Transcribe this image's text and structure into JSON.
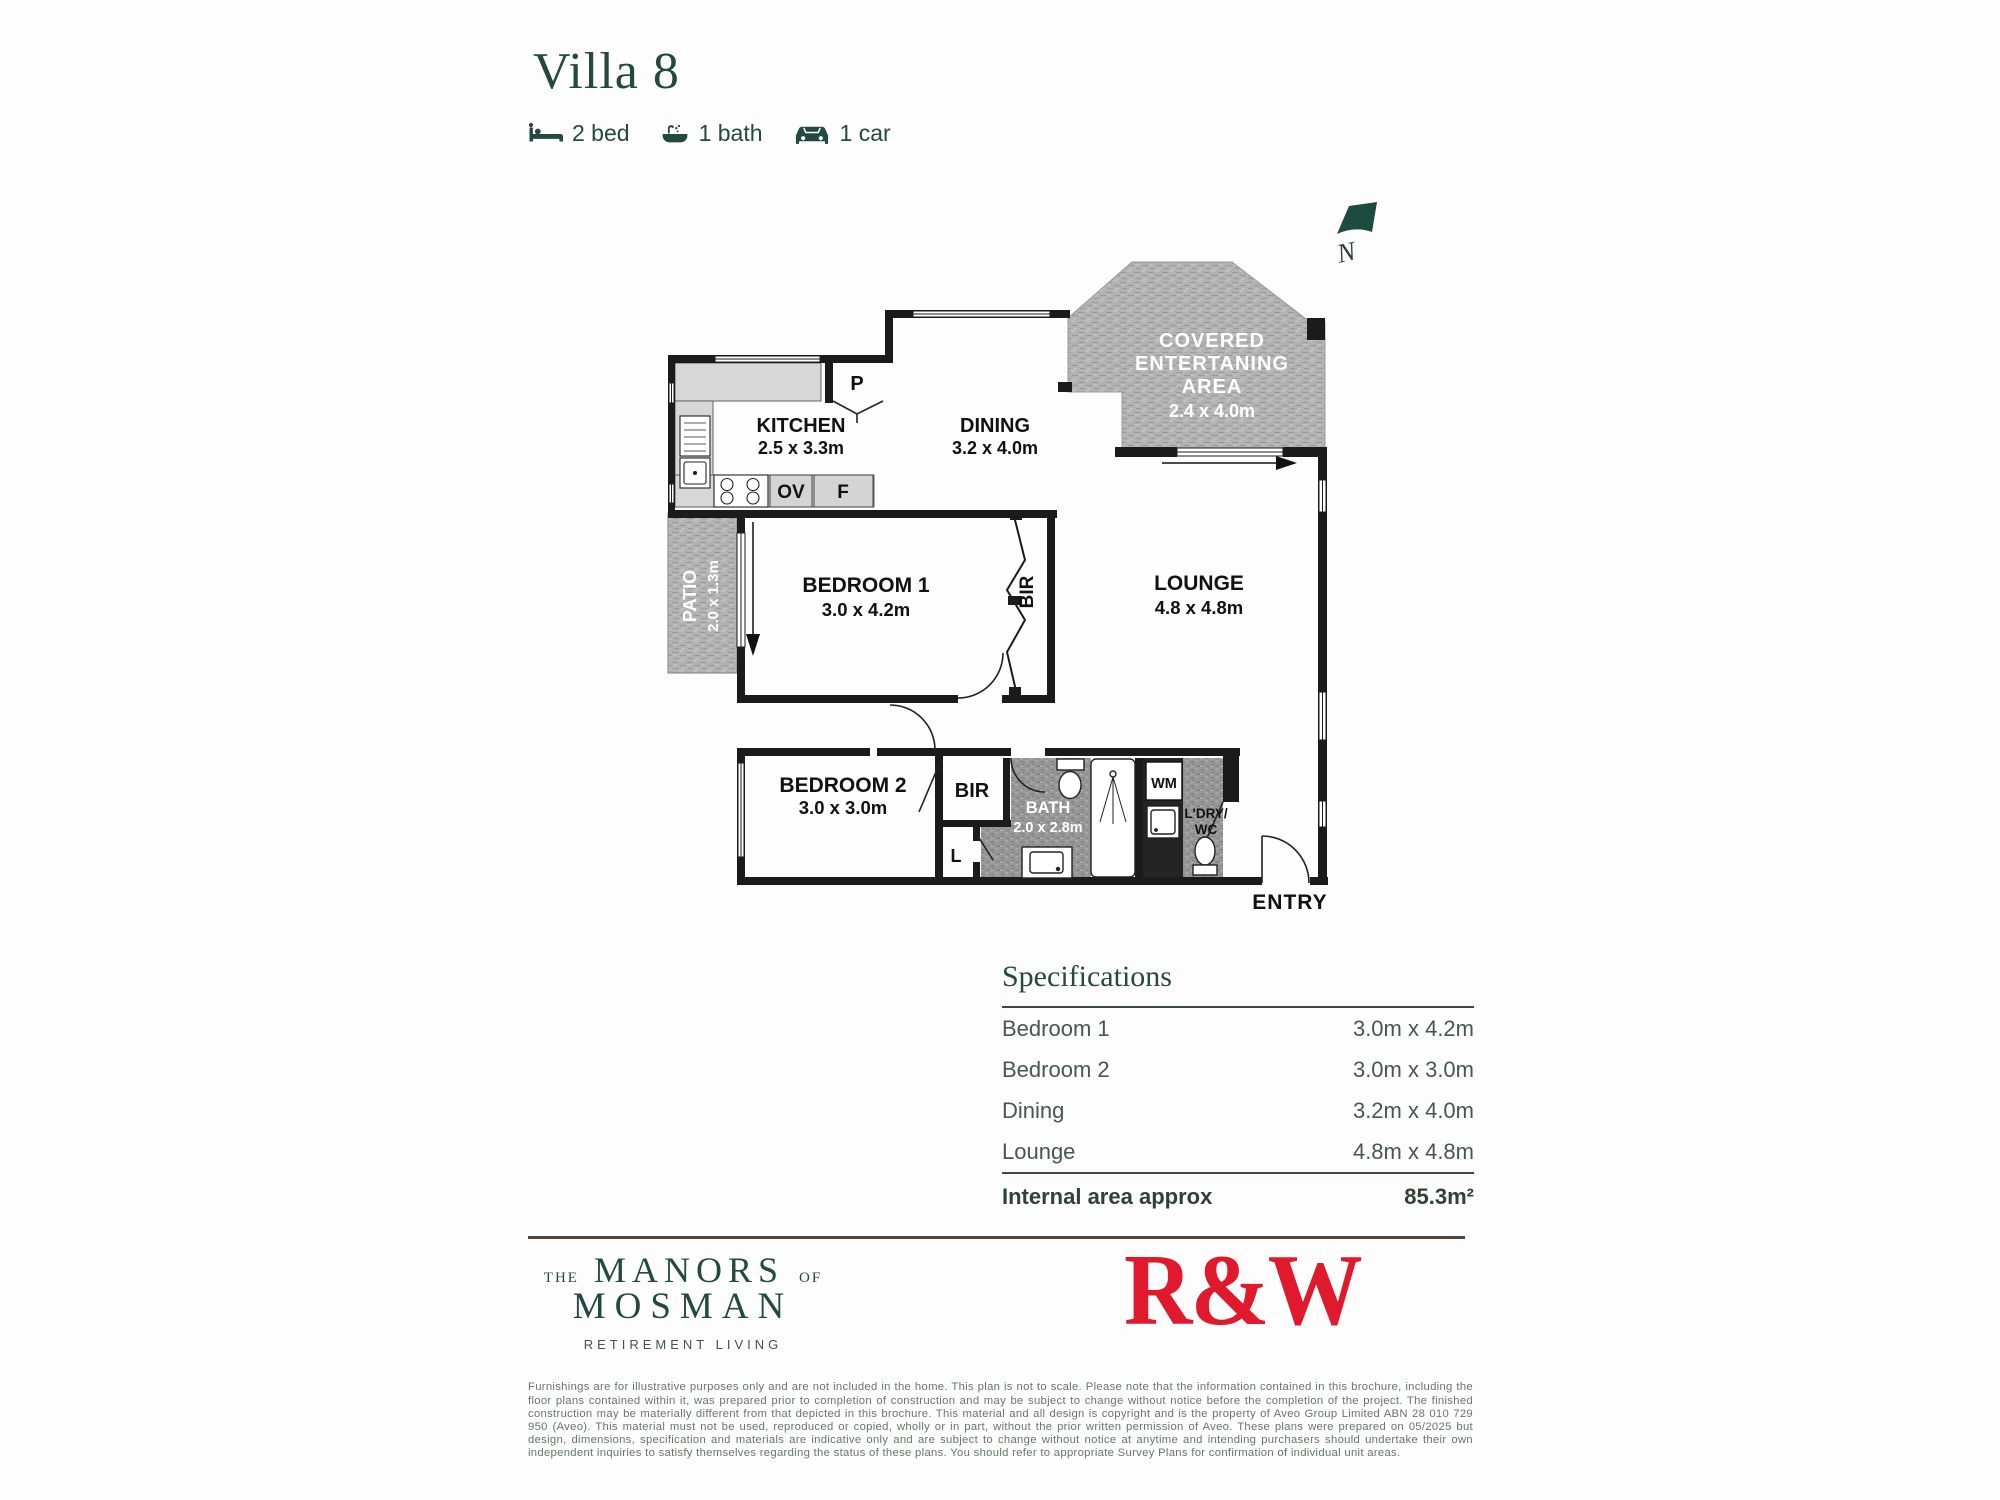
{
  "header": {
    "title": "Villa 8",
    "features": [
      {
        "icon": "bed-icon",
        "label": "2 bed"
      },
      {
        "icon": "bath-icon",
        "label": "1 bath"
      },
      {
        "icon": "car-icon",
        "label": "1 car"
      }
    ]
  },
  "floorplan": {
    "north": "N",
    "rooms": {
      "kitchen": {
        "name": "KITCHEN",
        "dims": "2.5 x 3.3m"
      },
      "dining": {
        "name": "DINING",
        "dims": "3.2 x 4.0m"
      },
      "covered_entertaining": {
        "line1": "COVERED",
        "line2": "ENTERTANING",
        "line3": "AREA",
        "dims": "2.4 x 4.0m"
      },
      "lounge": {
        "name": "LOUNGE",
        "dims": "4.8 x 4.8m"
      },
      "bedroom1": {
        "name": "BEDROOM 1",
        "dims": "3.0 x 4.2m"
      },
      "bedroom2": {
        "name": "BEDROOM 2",
        "dims": "3.0 x 3.0m"
      },
      "patio": {
        "name": "PATIO",
        "dims": "2.0 x 1.3m"
      },
      "bath": {
        "name": "BATH",
        "dims": "2.0 x 2.8m"
      },
      "laundry_wc": {
        "line1": "L'DRY/",
        "line2": "WC"
      },
      "entry": {
        "name": "ENTRY"
      }
    },
    "fixtures": {
      "pantry": "P",
      "oven": "OV",
      "fridge": "F",
      "robe1": "BIR",
      "robe2": "BIR",
      "linen": "L",
      "washing_machine": "WM"
    }
  },
  "specifications": {
    "title": "Specifications",
    "rows": [
      {
        "label": "Bedroom 1",
        "value": "3.0m x 4.2m"
      },
      {
        "label": "Bedroom 2",
        "value": "3.0m x 3.0m"
      },
      {
        "label": "Dining",
        "value": "3.2m x 4.0m"
      },
      {
        "label": "Lounge",
        "value": "4.8m x 4.8m"
      }
    ],
    "total_label": "Internal area approx",
    "total_value": "85.3m²"
  },
  "footer": {
    "brand": {
      "pre": "THE",
      "main": "MANORS",
      "post": "OF",
      "line2": "MOSMAN",
      "tagline": "RETIREMENT LIVING"
    },
    "agency": "R&W",
    "disclaimer": "Furnishings are for illustrative purposes only and are not included in the home. This plan is not to scale. Please note that the information contained in this brochure, including the floor plans contained within it, was prepared prior to completion of construction and may be subject to change without notice before the completion of the project. The finished construction may be materially different from that depicted in this brochure. This material and all design is copyright and is the property of Aveo Group Limited ABN 28 010 729 950 (Aveo). This material must not be used, reproduced or copied, wholly or in part, without the prior written permission of Aveo. These plans were prepared on 05/2025 but design, dimensions, specification and materials are indicative only and are subject to change without notice at anytime and intending purchasers should undertake their own independent inquiries to satisfy themselves regarding the status of these plans. You should refer to appropriate Survey Plans for confirmation of individual unit areas."
  },
  "colors": {
    "brand_green": "#24493e",
    "agency_red": "#e0192c",
    "wall_black": "#1b1b1b"
  }
}
